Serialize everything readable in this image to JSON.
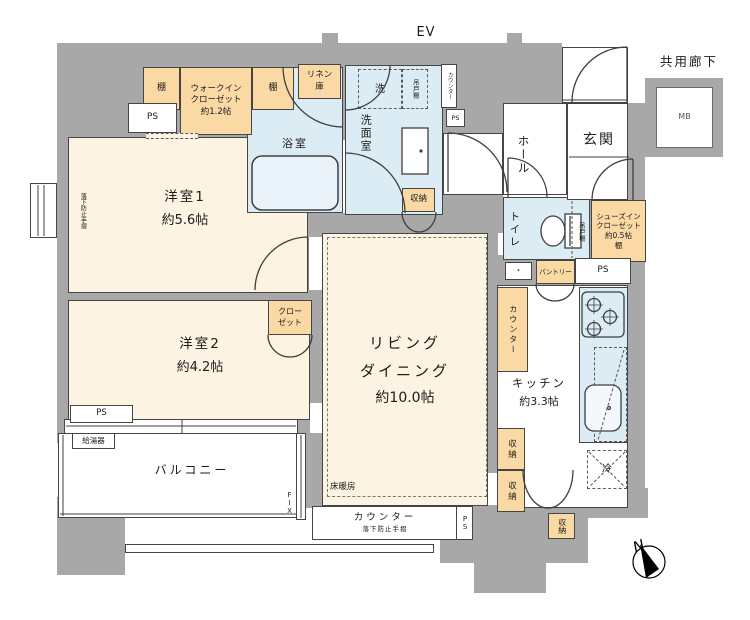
{
  "top": {
    "ev": "EV",
    "corridor": "共用廊下",
    "mb": "MB",
    "north": "N"
  },
  "rooms": {
    "yo1": {
      "name": "洋室1",
      "size": "約5.6帖"
    },
    "yo2": {
      "name": "洋室2",
      "size": "約4.2帖"
    },
    "ld": {
      "line1": "リビング",
      "line2": "ダイニング",
      "size": "約10.0帖",
      "floor_heating": "床暖房"
    },
    "kitchen": {
      "name": "キッチン",
      "size": "約3.3帖"
    },
    "bath": {
      "name": "浴室"
    },
    "wash": {
      "name": "洗面室",
      "washer": "洗",
      "cupboard": "吊戸棚",
      "counter": "カウンター"
    },
    "toilet": {
      "name": "トイレ",
      "cupboard": "吊戸棚"
    },
    "hall": {
      "name": "ホール"
    },
    "genkan": {
      "name": "玄関"
    },
    "balcony": {
      "name": "バルコニー",
      "fix": "FIX"
    }
  },
  "storage": {
    "shelf": "棚",
    "wic": {
      "line1": "ウォークイン",
      "line2": "クローゼット",
      "line3": "約1.2帖"
    },
    "linen": {
      "line1": "リネン",
      "line2": "庫"
    },
    "closet": {
      "line1": "クロー",
      "line2": "ゼット"
    },
    "sic": {
      "line1": "シューズイン",
      "line2": "クローゼット",
      "line3": "約0.5帖",
      "line4": "棚"
    },
    "pantry": "パントリー",
    "shuno": "収納",
    "cupboard": "吊戸棚",
    "counter": "カウンター"
  },
  "labels": {
    "ps": "PS",
    "water_heater": "給湯器",
    "fridge": "冷",
    "handrail": "落下防止手摺",
    "counter": "カウンター",
    "dot": "・"
  }
}
